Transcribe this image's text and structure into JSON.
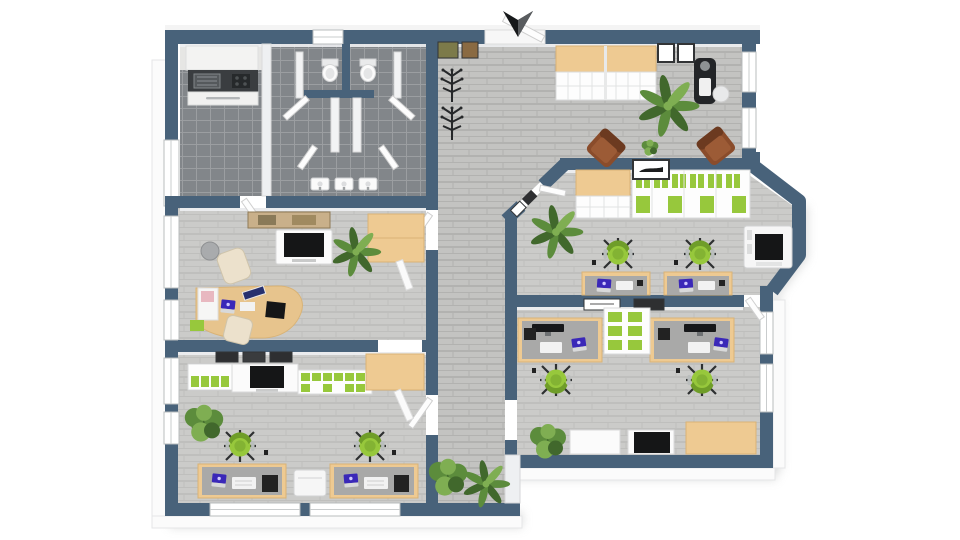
{
  "scene": {
    "kind": "3d-office-floor-plan-render",
    "compass_icon": "north-arrow",
    "background": "#ffffff"
  },
  "palette": {
    "wall": "#48627a",
    "wall_face": "#eef0f2",
    "rim": "#fbfbfb",
    "rim_edge": "#e5e6e7",
    "floor_hall": "#c3c3c1",
    "floor_hall_line": "#b2b2b0",
    "floor_room": "#cbcbc9",
    "floor_room_line": "#bfbfbd",
    "floor_wet": "#82868a",
    "floor_wet_line": "#9b9ea1",
    "counter_dark": "#3a3d40",
    "wood": "#eeca92",
    "wood_edge": "#d9b376",
    "desk_gray": "#a9a9a8",
    "green": "#97c83c",
    "green_dark": "#6f9d29",
    "plant_dark": "#41682c",
    "plant_mid": "#5c8c3c",
    "plant_light": "#7fae52",
    "brown": "#8a4c2b",
    "brown_dark": "#6c3a20",
    "purple": "#3a28b8",
    "dark": "#1d1f21",
    "white": "#ffffff",
    "paper": "#f5f5f5",
    "frame_dark": "#323436",
    "shadow": "#c9caca",
    "arrow_dark": "#17191b",
    "arrow_light": "#595c5f"
  },
  "rooms": [
    {
      "name": "kitchen",
      "furniture": [
        "kitchenette-counter",
        "sink",
        "cooktop",
        "base-cabinets",
        "dark-tile-floor"
      ]
    },
    {
      "name": "restrooms",
      "furniture": [
        "toilet",
        "toilet",
        "stall-partitions",
        "stall-doors",
        "sink-row"
      ]
    },
    {
      "name": "entry-hall",
      "furniture": [
        "entry-door",
        "wall-pictures",
        "coat-stands",
        "floor-plants"
      ]
    },
    {
      "name": "reception-waiting",
      "furniture": [
        "wood-top-shelving",
        "wall-pictures",
        "potted-palm",
        "vending-machine",
        "waste-bin",
        "guest-chair",
        "guest-chair",
        "side-plant"
      ]
    },
    {
      "name": "team-office-right",
      "furniture": [
        "wood-top-cabinet",
        "binder-shelving",
        "wall-picture",
        "potted-palm",
        "workstation",
        "workstation",
        "task-chair",
        "task-chair",
        "copier"
      ]
    },
    {
      "name": "team-office-bottom-right",
      "furniture": [
        "workstation",
        "workstation",
        "binder-sideboard",
        "wall-pictures",
        "tv-cabinet",
        "storage-cabinet",
        "wood-cabinet",
        "plant"
      ]
    },
    {
      "name": "manager-office",
      "furniture": [
        "curved-desk",
        "desk-chair",
        "lounge-chair",
        "ball-chair",
        "tv-sideboard",
        "wood-cabinet",
        "potted-palm",
        "panorama-picture",
        "paper-tray"
      ]
    },
    {
      "name": "team-office-bottom-left",
      "furniture": [
        "tv-sideboard",
        "binder-shelving",
        "wood-cabinet",
        "workstation",
        "workstation",
        "task-chair",
        "task-chair",
        "printer",
        "plant",
        "wall-pictures"
      ]
    }
  ]
}
